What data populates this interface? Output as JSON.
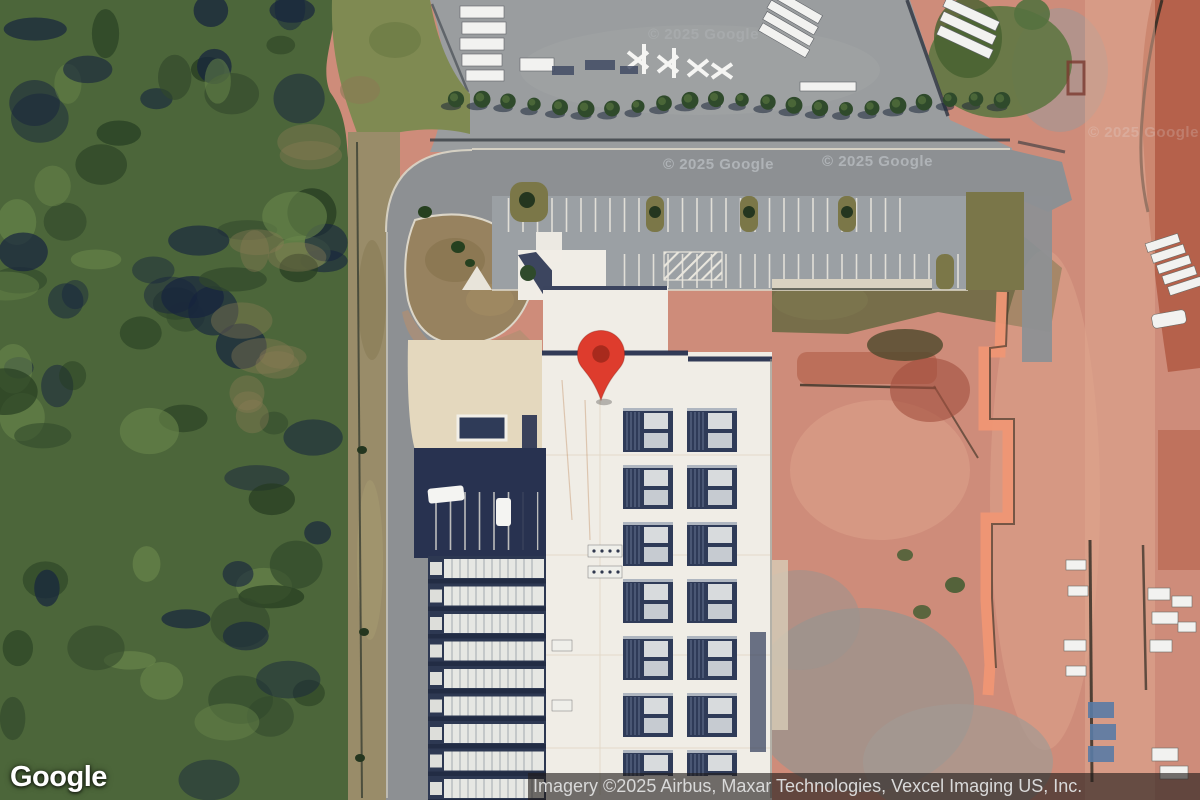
{
  "map": {
    "type": "satellite-imagery",
    "provider": "Google",
    "attribution": "Imagery ©2025 Airbus, Maxar Technologies, Vexcel Imaging US, Inc.",
    "watermark_text": "© 2025 Google",
    "marker": {
      "present": true,
      "description": "red-map-pin",
      "color": "#DE3C2D",
      "inner_color": "#A82A1D"
    }
  },
  "scene": {
    "features": [
      "forest-area-west",
      "construction-laydown-yard-north",
      "loop-access-road",
      "striped-parking-lot",
      "data-center-building-white-roof",
      "rooftop-hvac-solar-units",
      "chiller-equipment-yard-west",
      "graded-red-dirt-construction-area-east",
      "silt-fence-zigzag",
      "dirt-haul-road-east",
      "material-stacks",
      "tree-row-along-road"
    ]
  },
  "colors": {
    "pin_red": "#DE3C2D",
    "pin_red_dark": "#A82A1D",
    "pin_edge": "#8E2017",
    "forest_green": "#4C663A",
    "forest_dark": "#16243E",
    "grass_olive": "#7F8A52",
    "rough_tan": "#998C69",
    "road_gray": "#8D9093",
    "yard_gray": "#9A9D9F",
    "parking_gray": "#9BA0A4",
    "curb_light": "#DCD6C8",
    "building_white": "#F0EDE6",
    "panel_navy": "#2F3B58",
    "navy_shadow": "#283250",
    "plaza_beige": "#E4D8BE",
    "dirt_pink": "#CE8C7A",
    "dirt_light": "#DFA78F",
    "dirt_red": "#B25C46",
    "olive_band": "#6E6A45",
    "concrete_pale": "#D9D2C2",
    "silt_fence_salmon": "#EF9674",
    "attr_bg": "rgba(33,28,26,0.62)",
    "attr_text": "#D9D9D9",
    "watermark": "#E8EEF2",
    "logo_white": "#FFFFFF"
  }
}
